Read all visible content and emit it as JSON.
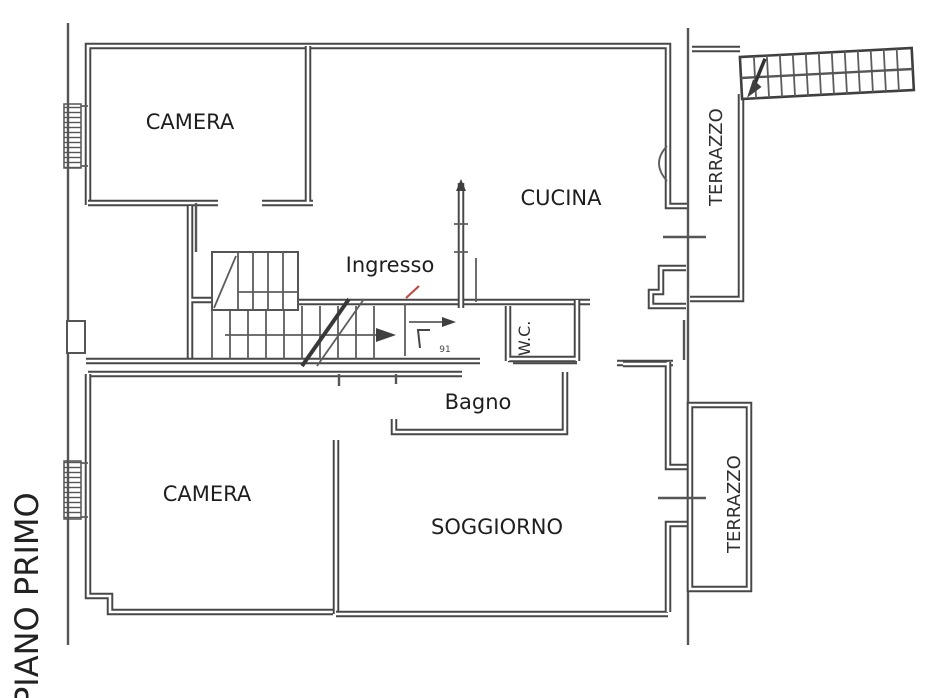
{
  "plan": {
    "floor_label": "PIANO PRIMO",
    "rooms": {
      "camera_top": "CAMERA",
      "cucina": "CUCINA",
      "ingresso": "Ingresso",
      "wc": "W.C.",
      "bagno": "Bagno",
      "camera_bottom": "CAMERA",
      "soggiorno": "SOGGIORNO",
      "terrazzo_top": "TERRAZZO",
      "terrazzo_bottom": "TERRAZZO"
    },
    "door_width_label": "91",
    "colors": {
      "wall": "#474747",
      "thin_line": "#5d5d5d",
      "label": "#1e1e1e",
      "entrance_mark": "#bf4a44"
    }
  }
}
